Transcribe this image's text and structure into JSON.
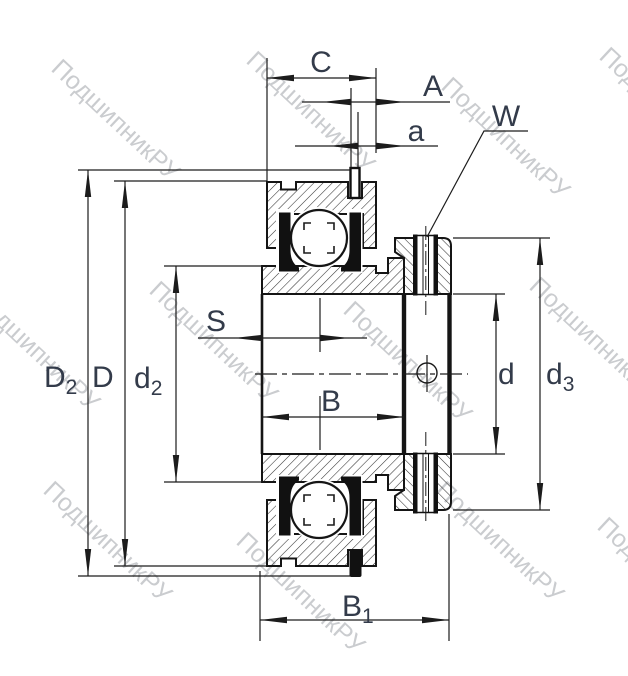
{
  "watermark": {
    "text": "ПодшипникРУ"
  },
  "labels": {
    "C": "C",
    "A": "A",
    "a": "a",
    "W": "W",
    "S": "S",
    "B": "B",
    "B1": {
      "main": "B",
      "sub": "1"
    },
    "D2": {
      "main": "D",
      "sub": "2"
    },
    "D": "D",
    "d2": {
      "main": "d",
      "sub": "2"
    },
    "d": "d",
    "d3": {
      "main": "d",
      "sub": "3"
    }
  },
  "colors": {
    "line": "#1c1c1c",
    "outline": "#151515",
    "label": "#333b4a",
    "hatch": "#333333",
    "background": "#ffffff",
    "watermark": "rgba(80,85,95,0.30)"
  }
}
